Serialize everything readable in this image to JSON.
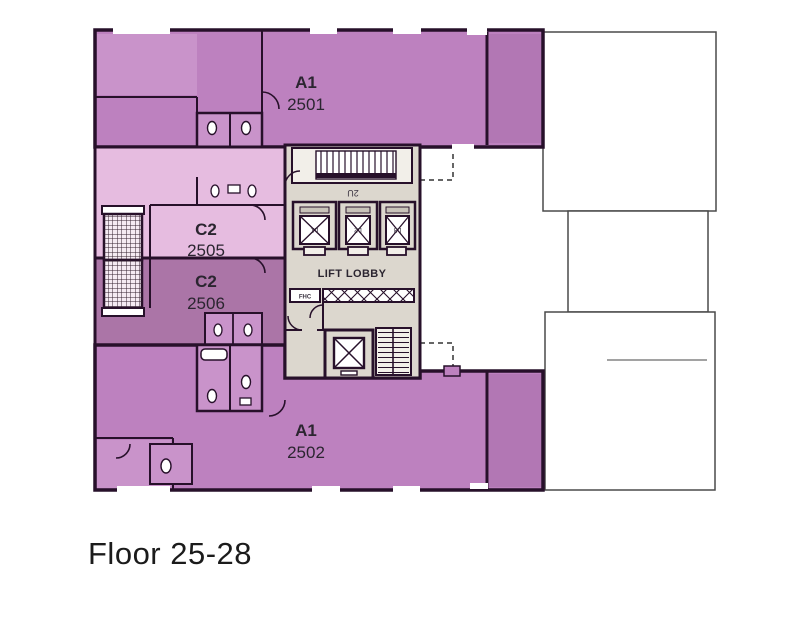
{
  "title": "Floor 25-28",
  "plan": {
    "units": [
      {
        "type": "A1",
        "number": "2501"
      },
      {
        "type": "A1",
        "number": "2502"
      },
      {
        "type": "C2",
        "number": "2505"
      },
      {
        "type": "C2",
        "number": "2506"
      }
    ],
    "core": {
      "lift_lobby_label": "LIFT LOBBY",
      "stair_label": "2U",
      "fhc_label": "FHC",
      "lifts": [
        {
          "label": "L1"
        },
        {
          "label": "L2"
        },
        {
          "label": "L3"
        }
      ]
    },
    "colors": {
      "unit_a1": "#bd81bf",
      "unit_a1_light": "#c993ca",
      "unit_a1_dark": "#b277b4",
      "unit_c2_2505": "#e6bce0",
      "unit_c2_2506": "#ab75a7",
      "bathroom": "#c993ca",
      "core_bg": "#dcd7ce",
      "stair_bg": "#f2efe9",
      "wall": "#27102a",
      "neighbor_outline": "#4a4a4a",
      "label_text": "#2b2530"
    }
  }
}
